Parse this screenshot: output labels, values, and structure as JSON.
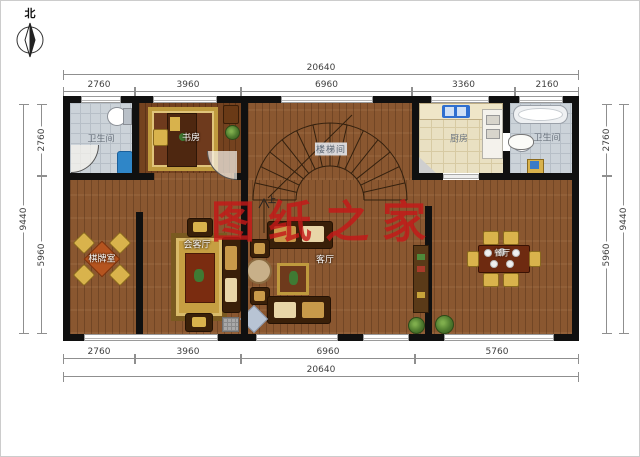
{
  "compass": {
    "label": "北"
  },
  "watermark": {
    "text": "图纸之家",
    "color": "#c51919"
  },
  "dimensions": {
    "top_total": "20640",
    "top_segments": [
      "2760",
      "3960",
      "6960",
      "3360",
      "2160"
    ],
    "bottom_segments": [
      "2760",
      "3960",
      "6960",
      "5760"
    ],
    "bottom_total": "20640",
    "left_segments": [
      "2760",
      "5960"
    ],
    "left_total": "9440",
    "right_segments": [
      "2760",
      "5960"
    ],
    "right_total": "9440"
  },
  "rooms": {
    "bathroom_left": {
      "label": "卫生间"
    },
    "study": {
      "label": "书房"
    },
    "stairwell": {
      "label": "楼梯间",
      "up_marker": "上"
    },
    "kitchen": {
      "label": "厨房"
    },
    "bathroom_right": {
      "label": "卫生间"
    },
    "chess_room": {
      "label": "棋牌室"
    },
    "reception": {
      "label": "会客厅"
    },
    "living_room": {
      "label": "客厅"
    },
    "dining_room": {
      "label": "餐厅"
    }
  },
  "colors": {
    "wall": "#101010",
    "wood_floor": "#8a5730",
    "wood_floor_dark": "#74421f",
    "bath_tile": "#ccd3d9",
    "kitchen_tile": "#e9e0c2",
    "rug_gold": "#bf9a3e",
    "sofa_brown": "#3a2009",
    "chair_gold": "#d9b34c",
    "sink_blue": "#2f6fd0",
    "watermark_red": "#c51919",
    "dimension_line": "#8f8f8f"
  }
}
